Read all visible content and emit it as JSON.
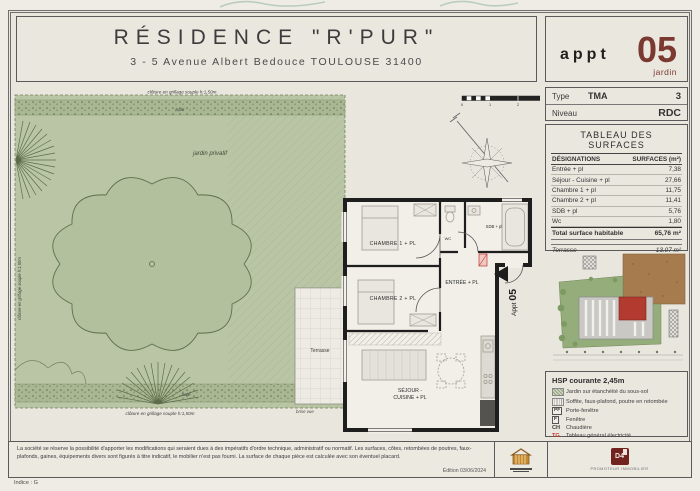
{
  "colors": {
    "accent_maroon": "#7b3a31",
    "accent_red": "#c0392b",
    "garden_green": "#b9c5a5",
    "site_brown": "#a67c4e"
  },
  "header": {
    "title": "RÉSIDENCE \"R'PUR\"",
    "address": "3 - 5 Avenue Albert Bedouce TOULOUSE 31400",
    "appt_label": "appt",
    "appt_number": "05",
    "appt_sub": "jardin"
  },
  "info": {
    "type_label": "Type",
    "type_value": "TMA",
    "type_count": "3",
    "niveau_label": "Niveau",
    "niveau_value": "RDC"
  },
  "surfaces": {
    "title": "TABLEAU DES SURFACES",
    "col_designations": "DÉSIGNATIONS",
    "col_surfaces": "SURFACES (m²)",
    "rows": [
      {
        "label": "Entrée + pl",
        "value": "7,38"
      },
      {
        "label": "Séjour - Cuisine + pl",
        "value": "27,66"
      },
      {
        "label": "Chambre 1 + pl",
        "value": "11,75"
      },
      {
        "label": "Chambre 2 + pl",
        "value": "11,41"
      },
      {
        "label": "SDB + pl",
        "value": "5,76"
      },
      {
        "label": "Wc",
        "value": "1,80"
      }
    ],
    "total_label": "Total surface habitable",
    "total_value": "65,76 m²",
    "annex_rows": [
      {
        "label": "Terrasse",
        "value": "13,07 m²"
      },
      {
        "label": "Jardin",
        "value": "202,50 m²"
      }
    ]
  },
  "legend": {
    "hsp": "HSP courante 2,45m",
    "items": [
      {
        "key": "",
        "label": "Jardin sur étanchéité du sous-sol"
      },
      {
        "key": "",
        "label": "Soffite, faux-plafond, poutre en retombée"
      },
      {
        "key": "PF",
        "label": "Porte-fenêtre"
      },
      {
        "key": "F",
        "label": "Fenêtre"
      },
      {
        "key": "CH",
        "label": "Chaudière"
      },
      {
        "key": "TG",
        "label": "Tableau général électricité"
      }
    ]
  },
  "plan": {
    "fence_top": "clôture en grillage souple h:1,50m",
    "fence_bottom": "clôture en grillage souple h:1,50m",
    "fence_left": "clôture en grillage souple h:1,50m",
    "haie_top": "haie",
    "haie_bottom": "haie",
    "jardin_label": "jardin privatif",
    "brise_vue": "brise vue",
    "terrasse": "Terrasse",
    "chambre1": "CHAMBRE 1 + PL",
    "chambre2": "CHAMBRE 2 + PL",
    "entree": "ENTRÉE + PL",
    "sdb": "SDB + pl",
    "wc": "WC",
    "sejour_line1": "SÉJOUR -",
    "sejour_line2": "CUISINE + PL",
    "appt_prefix": "Appt",
    "appt_number": "05",
    "scale_ticks": [
      "0",
      "1",
      "2",
      "3"
    ]
  },
  "footer": {
    "disclaimer": "La société se réserve la possibilité d'apporter les modifications qui seraient dues à des impératifs d'ordre technique, administratif ou normatif. Les surfaces, côtes, retombées de poutres, faux-plafonds, gaines, équipements divers sont figurés à titre indicatif, le mobilier n'est pas fourni. La surface de chaque pièce est calculée avec son éventuel placard.",
    "edition": "Édition 03/06/2024",
    "indice": "Indice : G",
    "d4_label": "D4",
    "d4_caption": "PROMOTEUR IMMOBILIER"
  }
}
